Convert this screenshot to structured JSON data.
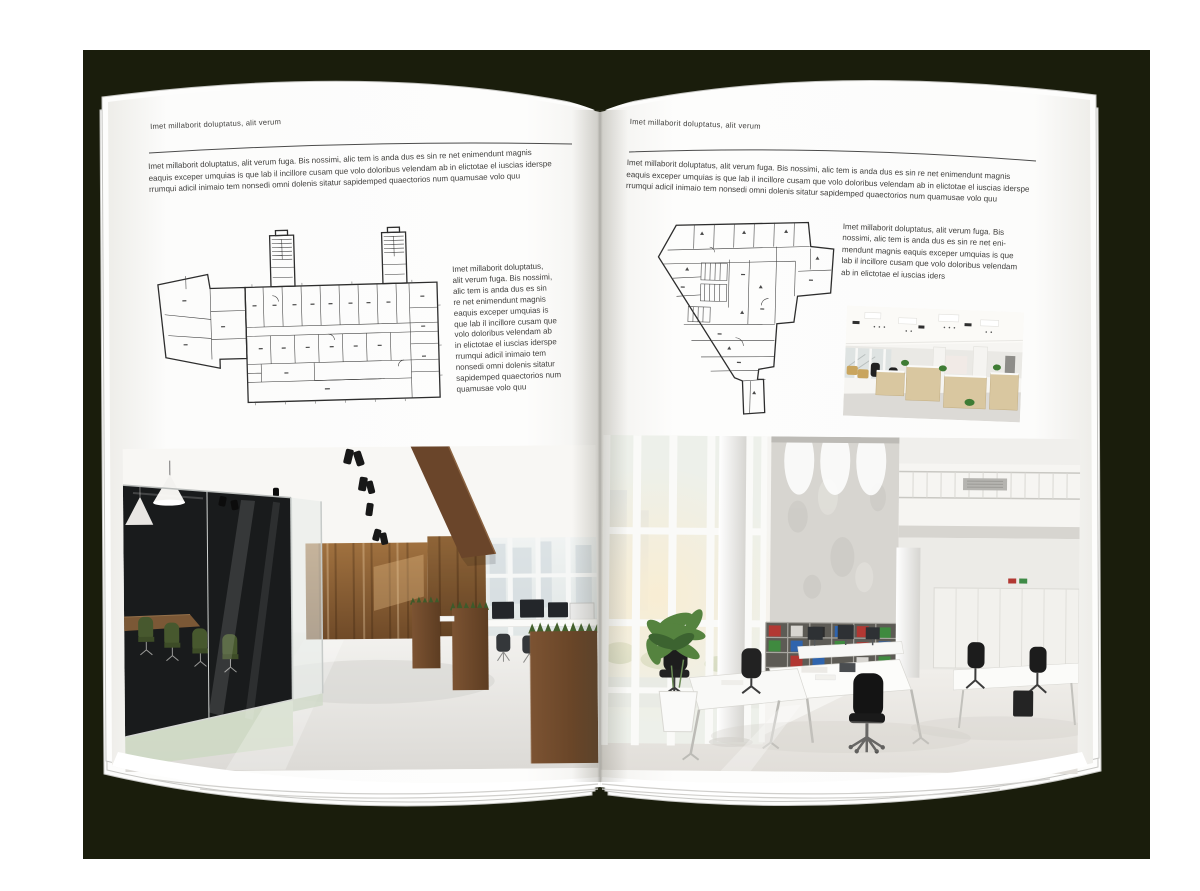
{
  "backdrop_color": "#1a1d0c",
  "page_color": "#ffffff",
  "text_color": "#3f3e3c",
  "left_page": {
    "header": "Imet millaborit doluptatus, alit verum",
    "intro_lines": [
      "Imet millaborit doluptatus, alit verum fuga. Bis nossimi, alic tem is anda dus es sin re net enimendunt magnis",
      "eaquis exceper umquias is que lab il incillore cusam que volo doloribus velendam ab in elictotae el iuscias iderspe",
      "rrumqui adicil inimaio tem nonsedi omni dolenis sitatur sapidemped quaectorios num quamusae volo quu"
    ],
    "side_text_lines": [
      "Imet millaborit doluptatus,",
      "alit verum fuga. Bis nossimi,",
      "alic tem is anda dus es sin",
      "re net enimendunt magnis",
      "eaquis exceper umquias is",
      "que lab il incillore cusam que",
      "volo doloribus velendam ab",
      "in elictotae el iuscias iderspe",
      "rrumqui adicil inimaio tem",
      "nonsedi omni dolenis sitatur",
      "sapidemped quaectorios num",
      "quamusae volo quu"
    ],
    "floor_plan_alt": "architectural floor plan of elongated office building with two stair towers",
    "photo_alt": "loft office interior with dark glass meeting room, wood walls and planter desks"
  },
  "right_page": {
    "header": "Imet millaborit doluptatus, alit verum",
    "intro_lines": [
      "Imet millaborit doluptatus, alit verum fuga. Bis nossimi, alic tem is anda dus es sin re net enimendunt magnis",
      "eaquis exceper umquias is que lab il incillore cusam que volo doloribus velendam ab in elictotae el iuscias iderspe",
      "rrumqui adicil inimaio tem nonsedi omni dolenis sitatur sapidemped quaectorios num quamusae volo quu"
    ],
    "side_text_lines": [
      "Imet millaborit doluptatus, alit verum fuga. Bis",
      "nossimi, alic tem is anda dus es sin re net eni-",
      "mendunt magnis eaquis exceper umquias is que",
      "lab il incillore cusam que volo doloribus velendam",
      "ab in elictotae el iuscias iders"
    ],
    "floor_plan_alt": "architectural floor plan of irregular tapering office building",
    "photo_small_alt": "open office with light wood cabinets, black chairs and glass partitions",
    "photo_alt": "double-height white office with window wall, binder shelves and white desks"
  }
}
